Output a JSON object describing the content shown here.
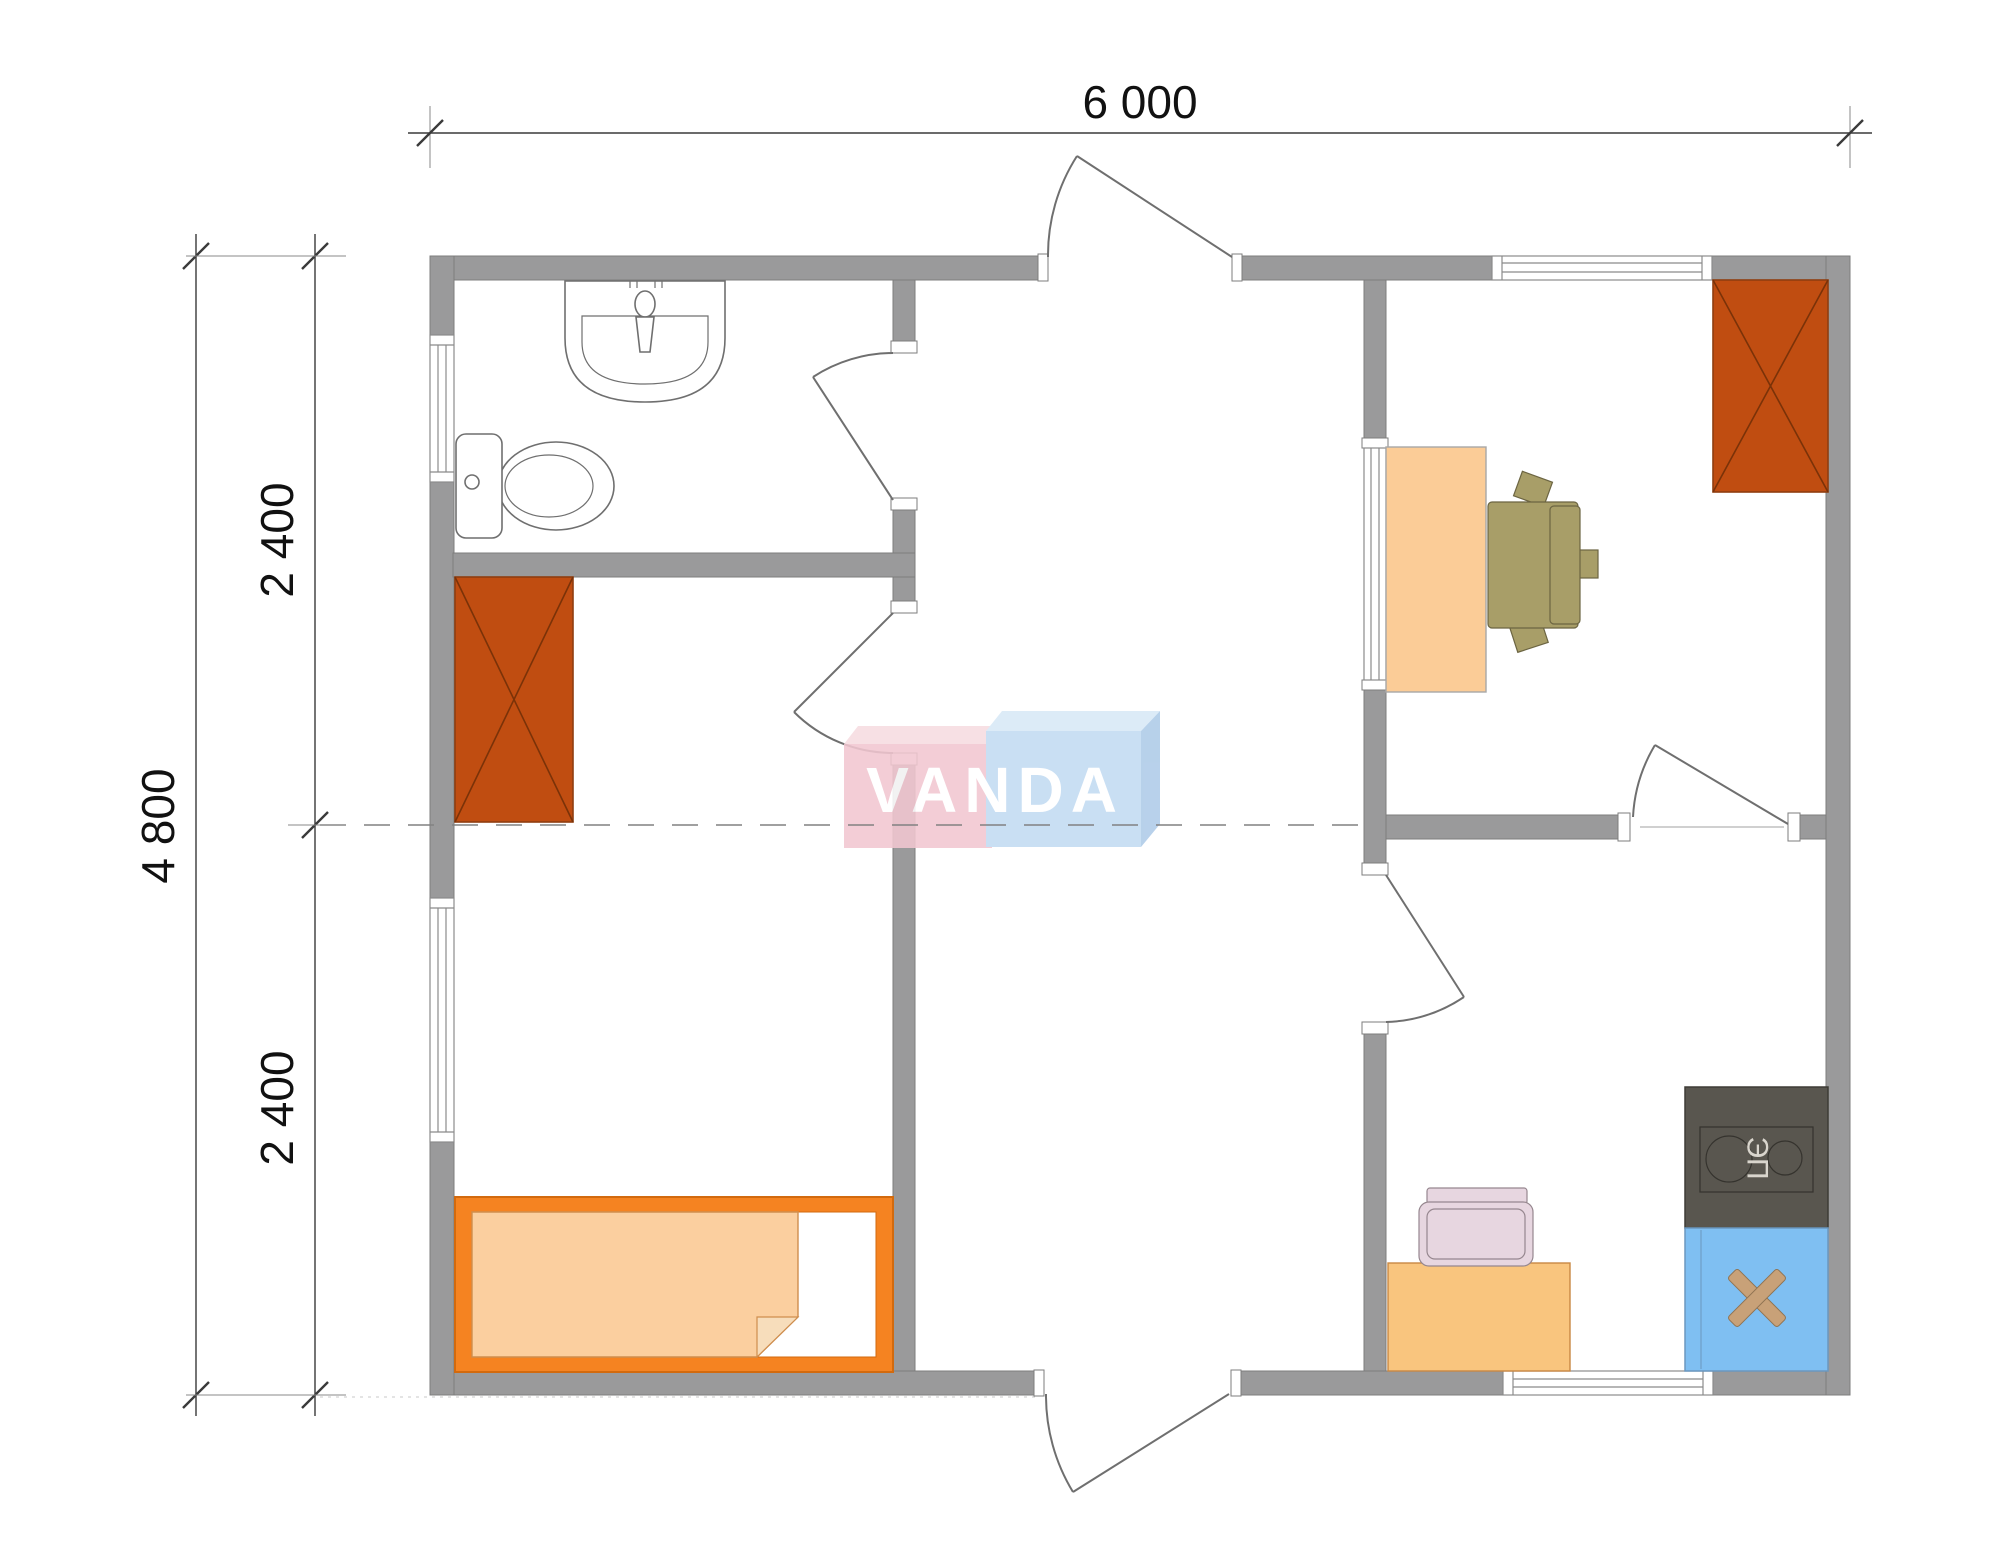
{
  "watermark": {
    "text": "VANDA"
  },
  "dimensions": {
    "top_width": "6 000",
    "left_total": "4 800",
    "left_upper": "2 400",
    "left_lower": "2 400"
  },
  "labels": {
    "stove": "ЭП"
  },
  "colors": {
    "wall": "#9A9A9B",
    "wallEdge": "#7D7D7D",
    "window": "#8B8B8B",
    "line": "#6F6F6F",
    "dim": "#3A3A3A",
    "dimText": "#111111",
    "wardrobe": "#C04D11",
    "wardrobeEdge": "#8F3E10",
    "wardrobeLine": "#7A3208",
    "bedFrame": "#F58321",
    "bedEdge": "#D26A0E",
    "mattress": "#FBCF9F",
    "mattressEdge": "#CF8E4E",
    "mattressFold": "#F7DDBB",
    "desk": "#FBCC97",
    "deskEdge": "#A8A8A8",
    "chairOlive": "#A89E68",
    "chairOliveEdge": "#6C6542",
    "stove": "#59564F",
    "stoveEdge": "#3E3C36",
    "stoveInner": "#35332E",
    "stoveText": "#D9D5CD",
    "sinkBlue": "#7FBFF2",
    "sinkBlueEdge": "#6B97BF",
    "cross": "#C8A178",
    "crossEdge": "#8F7352",
    "table": "#F9C57E",
    "tableEdge": "#C98844",
    "chairPink": "#E7D6E0",
    "chairPinkEdge": "#96878F",
    "wmPink": "#F2C7D1",
    "wmPinkTop": "#F7DCE1",
    "wmBlue": "#C2DBF2",
    "wmBlueTop": "#D8E9F7",
    "wmBlueSide": "#AECBE8",
    "wmText": "#FFFFFF"
  }
}
